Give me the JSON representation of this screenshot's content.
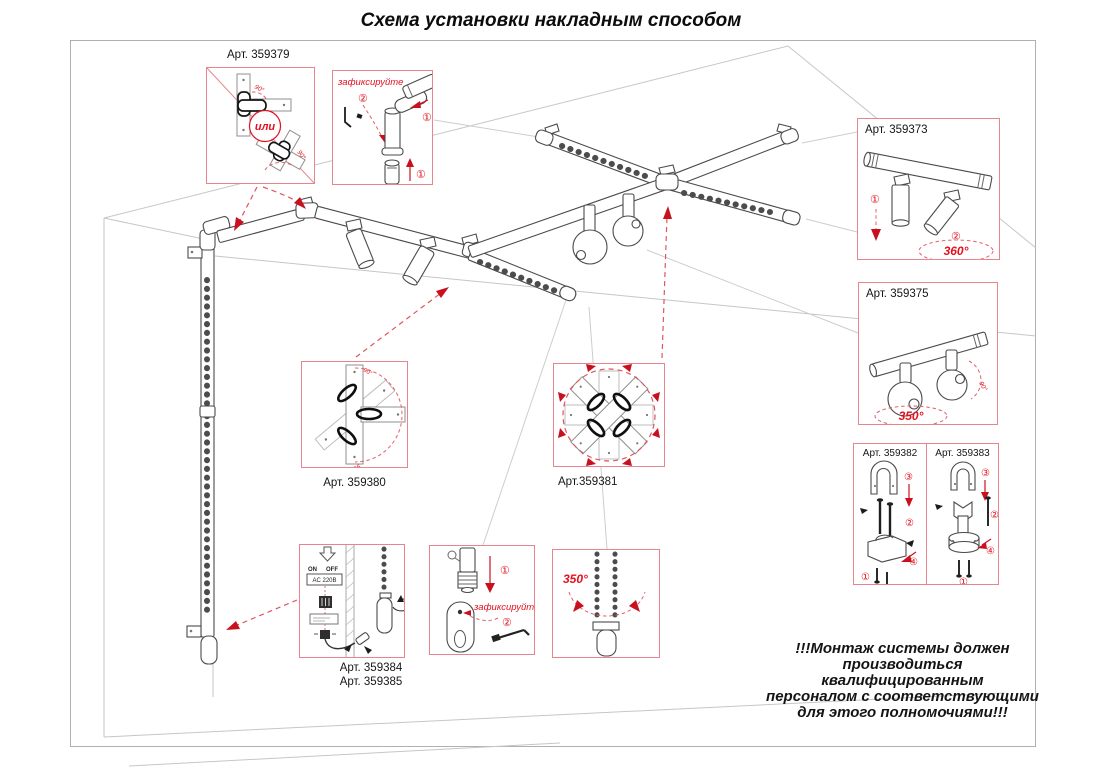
{
  "title": "Схема установки накладным способом",
  "callouts": {
    "a379": {
      "label": "Арт. 359379",
      "or": "или",
      "angle_a": "90°",
      "angle_b": "90°"
    },
    "fix_top": {
      "title": "зафиксируйте",
      "step1": "①",
      "step2": "②"
    },
    "a373": {
      "label": "Арт. 359373",
      "step1": "①",
      "step2": "②",
      "angle": "360°"
    },
    "a375": {
      "label": "Арт. 359375",
      "angle": "350°",
      "angle_small": "90°"
    },
    "a382": {
      "label": "Арт. 359382",
      "s1": "①",
      "s2": "②",
      "s3": "③",
      "s4": "④"
    },
    "a383": {
      "label": "Арт. 359383",
      "s1": "①",
      "s2": "②",
      "s3": "③",
      "s4": "④"
    },
    "a380": {
      "label": "Арт. 359380",
      "angle_top": "90°",
      "angle_bottom": "90°"
    },
    "a381": {
      "label": "Арт.359381"
    },
    "a384": {
      "label1": "Арт. 359384",
      "label2": "Арт. 359385",
      "on": "ON",
      "off": "OFF",
      "ac": "AC 220В"
    },
    "fix_bottom": {
      "title": "зафиксируйте",
      "step1": "①",
      "step2": "②"
    },
    "rot350": {
      "angle": "350°"
    }
  },
  "warning": {
    "line1": "!!!Монтаж системы должен",
    "line2": "производиться квалифицированным",
    "line3": "персоналом с соответствующими",
    "line4": "для этого полномочиями!!!"
  },
  "colors": {
    "accent_red": "#e3111f",
    "box_border": "#e8848c"
  }
}
